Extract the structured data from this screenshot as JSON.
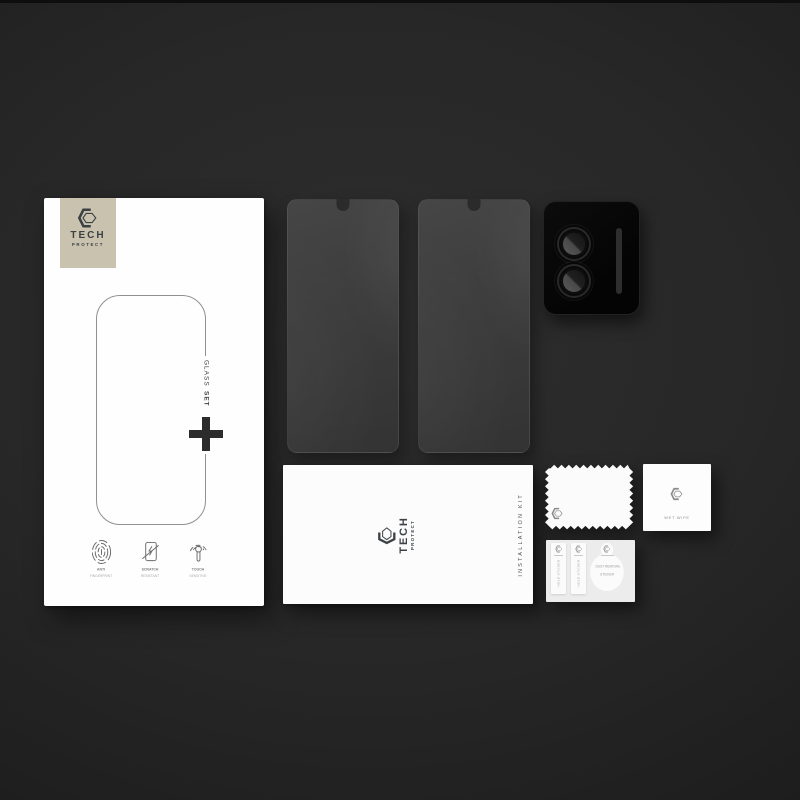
{
  "brand": {
    "word1": "TECH",
    "word2": "PROTECT"
  },
  "box": {
    "glass_label": "GLASS",
    "set_label": "SET",
    "features": [
      {
        "icon": "fingerprint-icon",
        "label_line1": "ANTI",
        "label_line2": "FINGERPRINT"
      },
      {
        "icon": "scratch-icon",
        "label_line1": "SCRATCH",
        "label_line2": "RESISTANT"
      },
      {
        "icon": "touch-icon",
        "label_line1": "TOUCH",
        "label_line2": "SENSITIVE"
      }
    ]
  },
  "kit": {
    "word1": "TECH",
    "word2": "PROTECT",
    "side_label": "INSTALLATION KIT"
  },
  "wet_wipe": {
    "label": "WET WIPE"
  },
  "sticker_card": {
    "strips": [
      {
        "label": "HOLD STICKER"
      },
      {
        "label": "HOLD STICKER"
      }
    ],
    "dust_sticker": {
      "line1": "DUST REMOVAL",
      "line2": "STICKER"
    }
  },
  "icons": {
    "brand_logo": "hexagon-logo-icon",
    "box_center": "plus-icon",
    "features": [
      "fingerprint-icon",
      "scratch-icon",
      "touch-icon"
    ]
  },
  "colors": {
    "background": "#262626",
    "brand_patch": "#c9c2ae",
    "paper_white": "#fcfcfc",
    "camera_black": "#070707",
    "glass_gray": "#3e3e3e",
    "logo_ink": "#3c4145"
  }
}
